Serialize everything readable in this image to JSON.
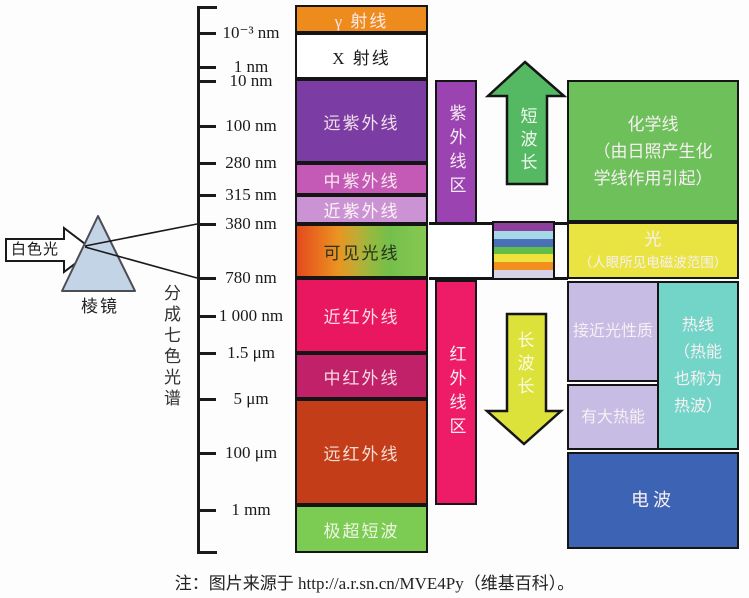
{
  "prism_section": {
    "white_light_label": "白色光",
    "white_light_fill": "#ffffff",
    "prism_label": "棱镜",
    "prism_fill": "#c3d4e7",
    "split_label": "分成七色光谱"
  },
  "axis": {
    "ticks": [
      {
        "label": "10⁻³ nm",
        "y": 33
      },
      {
        "label": "1 nm",
        "y": 67
      },
      {
        "label": "10 nm",
        "y": 81
      },
      {
        "label": "100 nm",
        "y": 126
      },
      {
        "label": "280 nm",
        "y": 163
      },
      {
        "label": "315 nm",
        "y": 195
      },
      {
        "label": "380 nm",
        "y": 224
      },
      {
        "label": "780 nm",
        "y": 278
      },
      {
        "label": "1 000 nm",
        "y": 316
      },
      {
        "label": "1.5 μm",
        "y": 353
      },
      {
        "label": "5 μm",
        "y": 399
      },
      {
        "label": "100 μm",
        "y": 453
      },
      {
        "label": "1 mm",
        "y": 510
      }
    ]
  },
  "spectrum_bands": [
    {
      "label": "γ 射线",
      "y1": 5,
      "y2": 33,
      "color": "#ee8b1d",
      "text_color": "#fbe9ec"
    },
    {
      "label": "X 射线",
      "y1": 33,
      "y2": 79,
      "color": "#ffffff",
      "text_color": "#1a1a1a"
    },
    {
      "label": "远紫外线",
      "y1": 79,
      "y2": 163,
      "color": "#7b3ca4",
      "text_color": "#f3dfe8"
    },
    {
      "label": "中紫外线",
      "y1": 163,
      "y2": 195,
      "color": "#c45ab6",
      "text_color": "#f8e8ef"
    },
    {
      "label": "近紫外线",
      "y1": 195,
      "y2": 224,
      "color": "#cb93d4",
      "text_color": "#fdf4f6"
    },
    {
      "label": "可见光线",
      "y1": 224,
      "y2": 278,
      "color": "#9fbd3c",
      "gradient": "linear-gradient(90deg,#e44a1e 0%,#e9731f 18%,#ea9422 32%,#c0ab35 46%,#94ba3f 58%,#74bf4b 72%,#7fc54f 88%,#86c851 100%)",
      "text_color": "#27321b"
    },
    {
      "label": "近红外线",
      "y1": 278,
      "y2": 353,
      "color": "#e9175f",
      "text_color": "#fbdde4"
    },
    {
      "label": "中红外线",
      "y1": 353,
      "y2": 399,
      "color": "#c02169",
      "text_color": "#f6dce6"
    },
    {
      "label": "远红外线",
      "y1": 399,
      "y2": 505,
      "color": "#c33d18",
      "text_color": "#f6ddd6"
    },
    {
      "label": "极超短波",
      "y1": 505,
      "y2": 553,
      "color": "#7ccb52",
      "text_color": "#eef7e3"
    }
  ],
  "region_bars": {
    "uv": {
      "label": "紫外线区",
      "color": "#9c43b2"
    },
    "ir": {
      "label": "红外线区",
      "color": "#ee1b67"
    }
  },
  "arrows": {
    "up": {
      "label": "短波长",
      "color": "#55b964"
    },
    "down": {
      "label": "长波长",
      "color": "#dde23b"
    }
  },
  "rainbow": {
    "stripes": [
      "#8e3f9e",
      "#a6d9e8",
      "#4a71b8",
      "#63bd49",
      "#efe23d",
      "#f2901f",
      "#d9d3e9"
    ]
  },
  "right_panel": {
    "chemical": {
      "lines": [
        "化学线",
        "（由日照产生化",
        "学线作用引起）"
      ],
      "color": "#6ec05b"
    },
    "light": {
      "lines": [
        "光",
        "（人眼所见电磁波范围）"
      ],
      "color": "#e9e441"
    },
    "near_light": {
      "label": "接近光性质",
      "color": "#c6bce4"
    },
    "heat_energy": {
      "label": "有大热能",
      "color": "#c6bce4"
    },
    "heat_ray": {
      "lines": [
        "热线",
        "（热能",
        "也称为",
        "热波）"
      ],
      "color": "#73d5c8"
    },
    "radio": {
      "label": "电波",
      "color": "#3d63b4"
    }
  },
  "note": "注：图片来源于 http://a.r.sn.cn/MVE4Py（维基百科）。"
}
